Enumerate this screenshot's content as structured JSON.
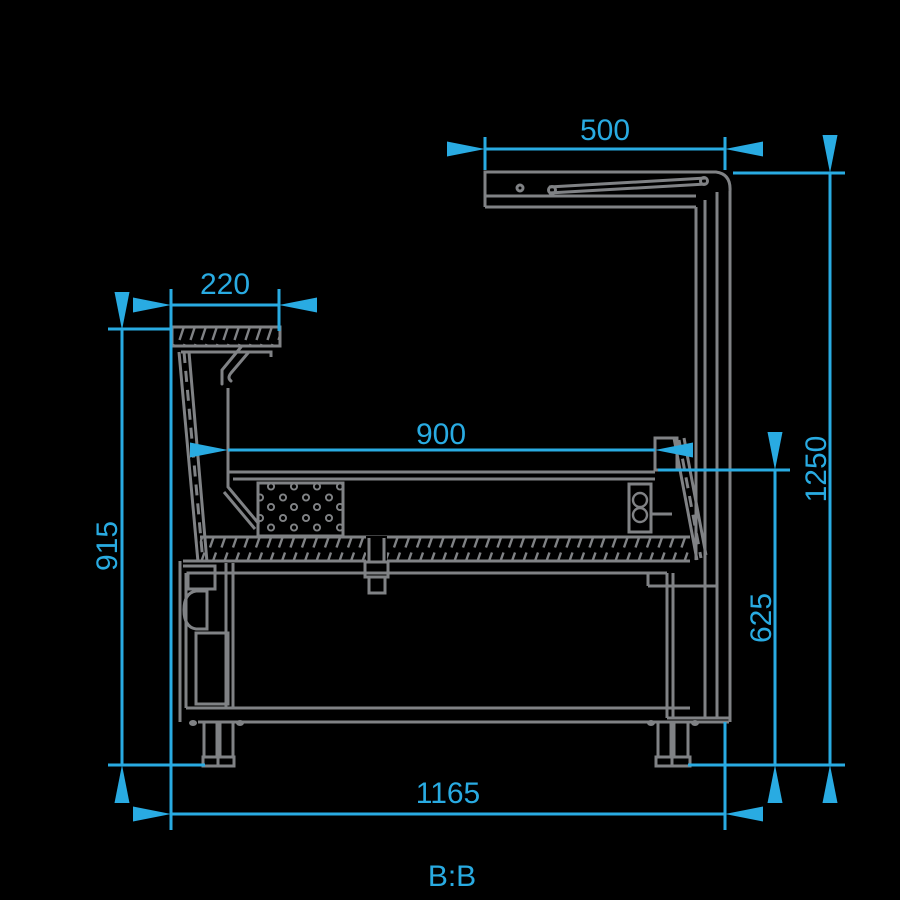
{
  "drawing": {
    "section_label": "B:B",
    "type": "refrigerated-display-counter-cross-section",
    "dimensions": {
      "canopy_width": "500",
      "overshelf_depth": "220",
      "display_well_width": "900",
      "front_height": "915",
      "rear_inner_height": "625",
      "overall_height": "1250",
      "overall_depth": "1165"
    },
    "colors": {
      "dimension_blue": "#29ABE2",
      "linework_gray": "#808285",
      "background": "#000000"
    }
  }
}
